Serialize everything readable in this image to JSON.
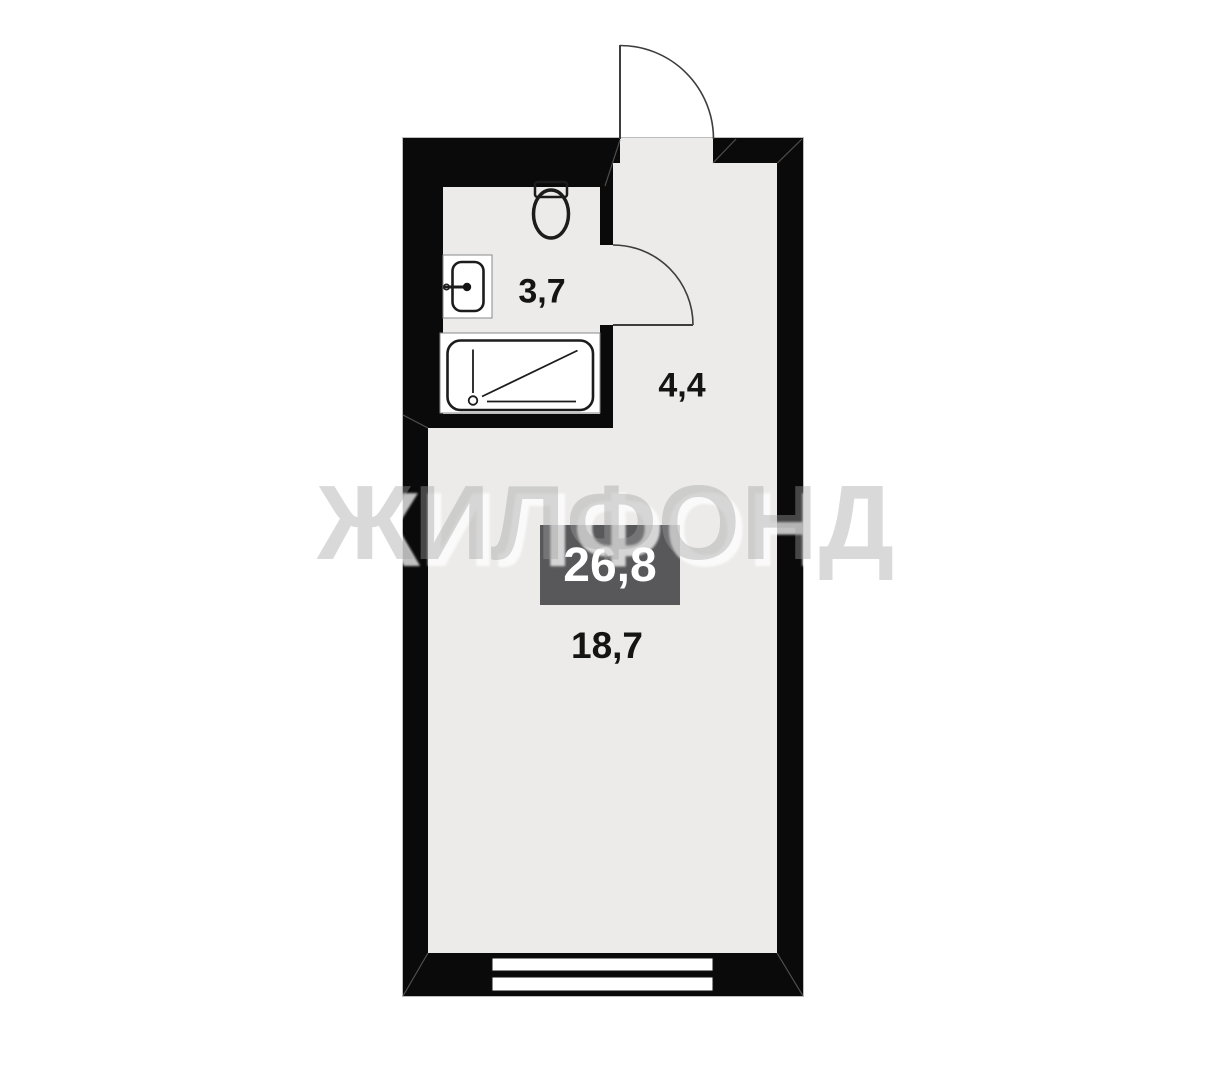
{
  "watermark": "ЖИЛФОНД",
  "areas": {
    "bathroom": "3,7",
    "hallway": "4,4",
    "room": "18,7",
    "total": "26,8"
  },
  "colors": {
    "wall": "#0A0A0A",
    "floor": "#ECEBE9",
    "outside": "#FFFFFF",
    "badge_bg": "#58585A",
    "badge_text": "#FFFFFF",
    "label_text": "#141414",
    "door_line": "#3D3D3D",
    "fixture_line": "#1C1C1C",
    "watermark_fill": "rgba(160,160,160,0.40)",
    "watermark_shadow": "rgba(255,255,255,0.75)"
  }
}
